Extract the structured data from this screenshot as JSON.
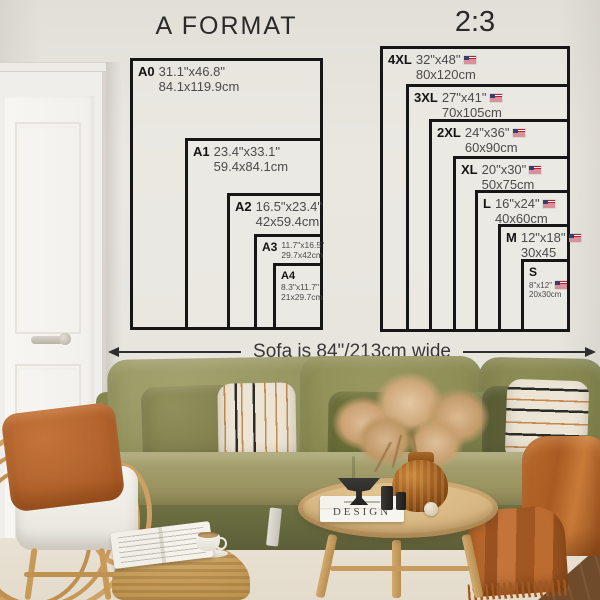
{
  "titles": {
    "a_format": "A FORMAT",
    "ratio": "2:3"
  },
  "sofa_note": "Sofa is 84\"/213cm wide",
  "a_format_sizes": [
    {
      "label": "A0",
      "inches": "31.1\"x46.8\"",
      "cm": "84.1x119.9cm"
    },
    {
      "label": "A1",
      "inches": "23.4\"x33.1\"",
      "cm": "59.4x84.1cm"
    },
    {
      "label": "A2",
      "inches": "16.5\"x23.4\"",
      "cm": "42x59.4cm"
    },
    {
      "label": "A3",
      "inches": "11.7\"x16.5\"",
      "cm": "29.7x42cm"
    },
    {
      "label": "A4",
      "inches": "8.3\"x11.7\"",
      "cm": "21x29.7cm"
    }
  ],
  "ratio_sizes": [
    {
      "label": "4XL",
      "inches": "32\"x48\"",
      "cm": "80x120cm",
      "flag": "us-flag"
    },
    {
      "label": "3XL",
      "inches": "27\"x41\"",
      "cm": "70x105cm",
      "flag": "us-flag"
    },
    {
      "label": "2XL",
      "inches": "24\"x36\"",
      "cm": "60x90cm",
      "flag": "us-flag"
    },
    {
      "label": "XL",
      "inches": "20\"x30\"",
      "cm": "50x75cm",
      "flag": "us-flag"
    },
    {
      "label": "L",
      "inches": "16\"x24\"",
      "cm": "40x60cm",
      "flag": "us-flag"
    },
    {
      "label": "M",
      "inches": "12\"x18\"",
      "cm": "30x45",
      "flag": "us-flag"
    },
    {
      "label": "S",
      "inches": "8\"x12\"",
      "cm": "20x30cm",
      "flag": "us-flag"
    }
  ],
  "decor": {
    "book_title": "DESIGN"
  },
  "colors": {
    "chart_line": "#161616",
    "wall": "#e8e5df",
    "sofa_olive": "#8f8e58",
    "rust": "#b5662b",
    "rattan": "#cda063",
    "wood_floor": "#6f4b2b"
  },
  "icons": {
    "flag": "us-flag",
    "width_arrow": "double-arrow"
  }
}
